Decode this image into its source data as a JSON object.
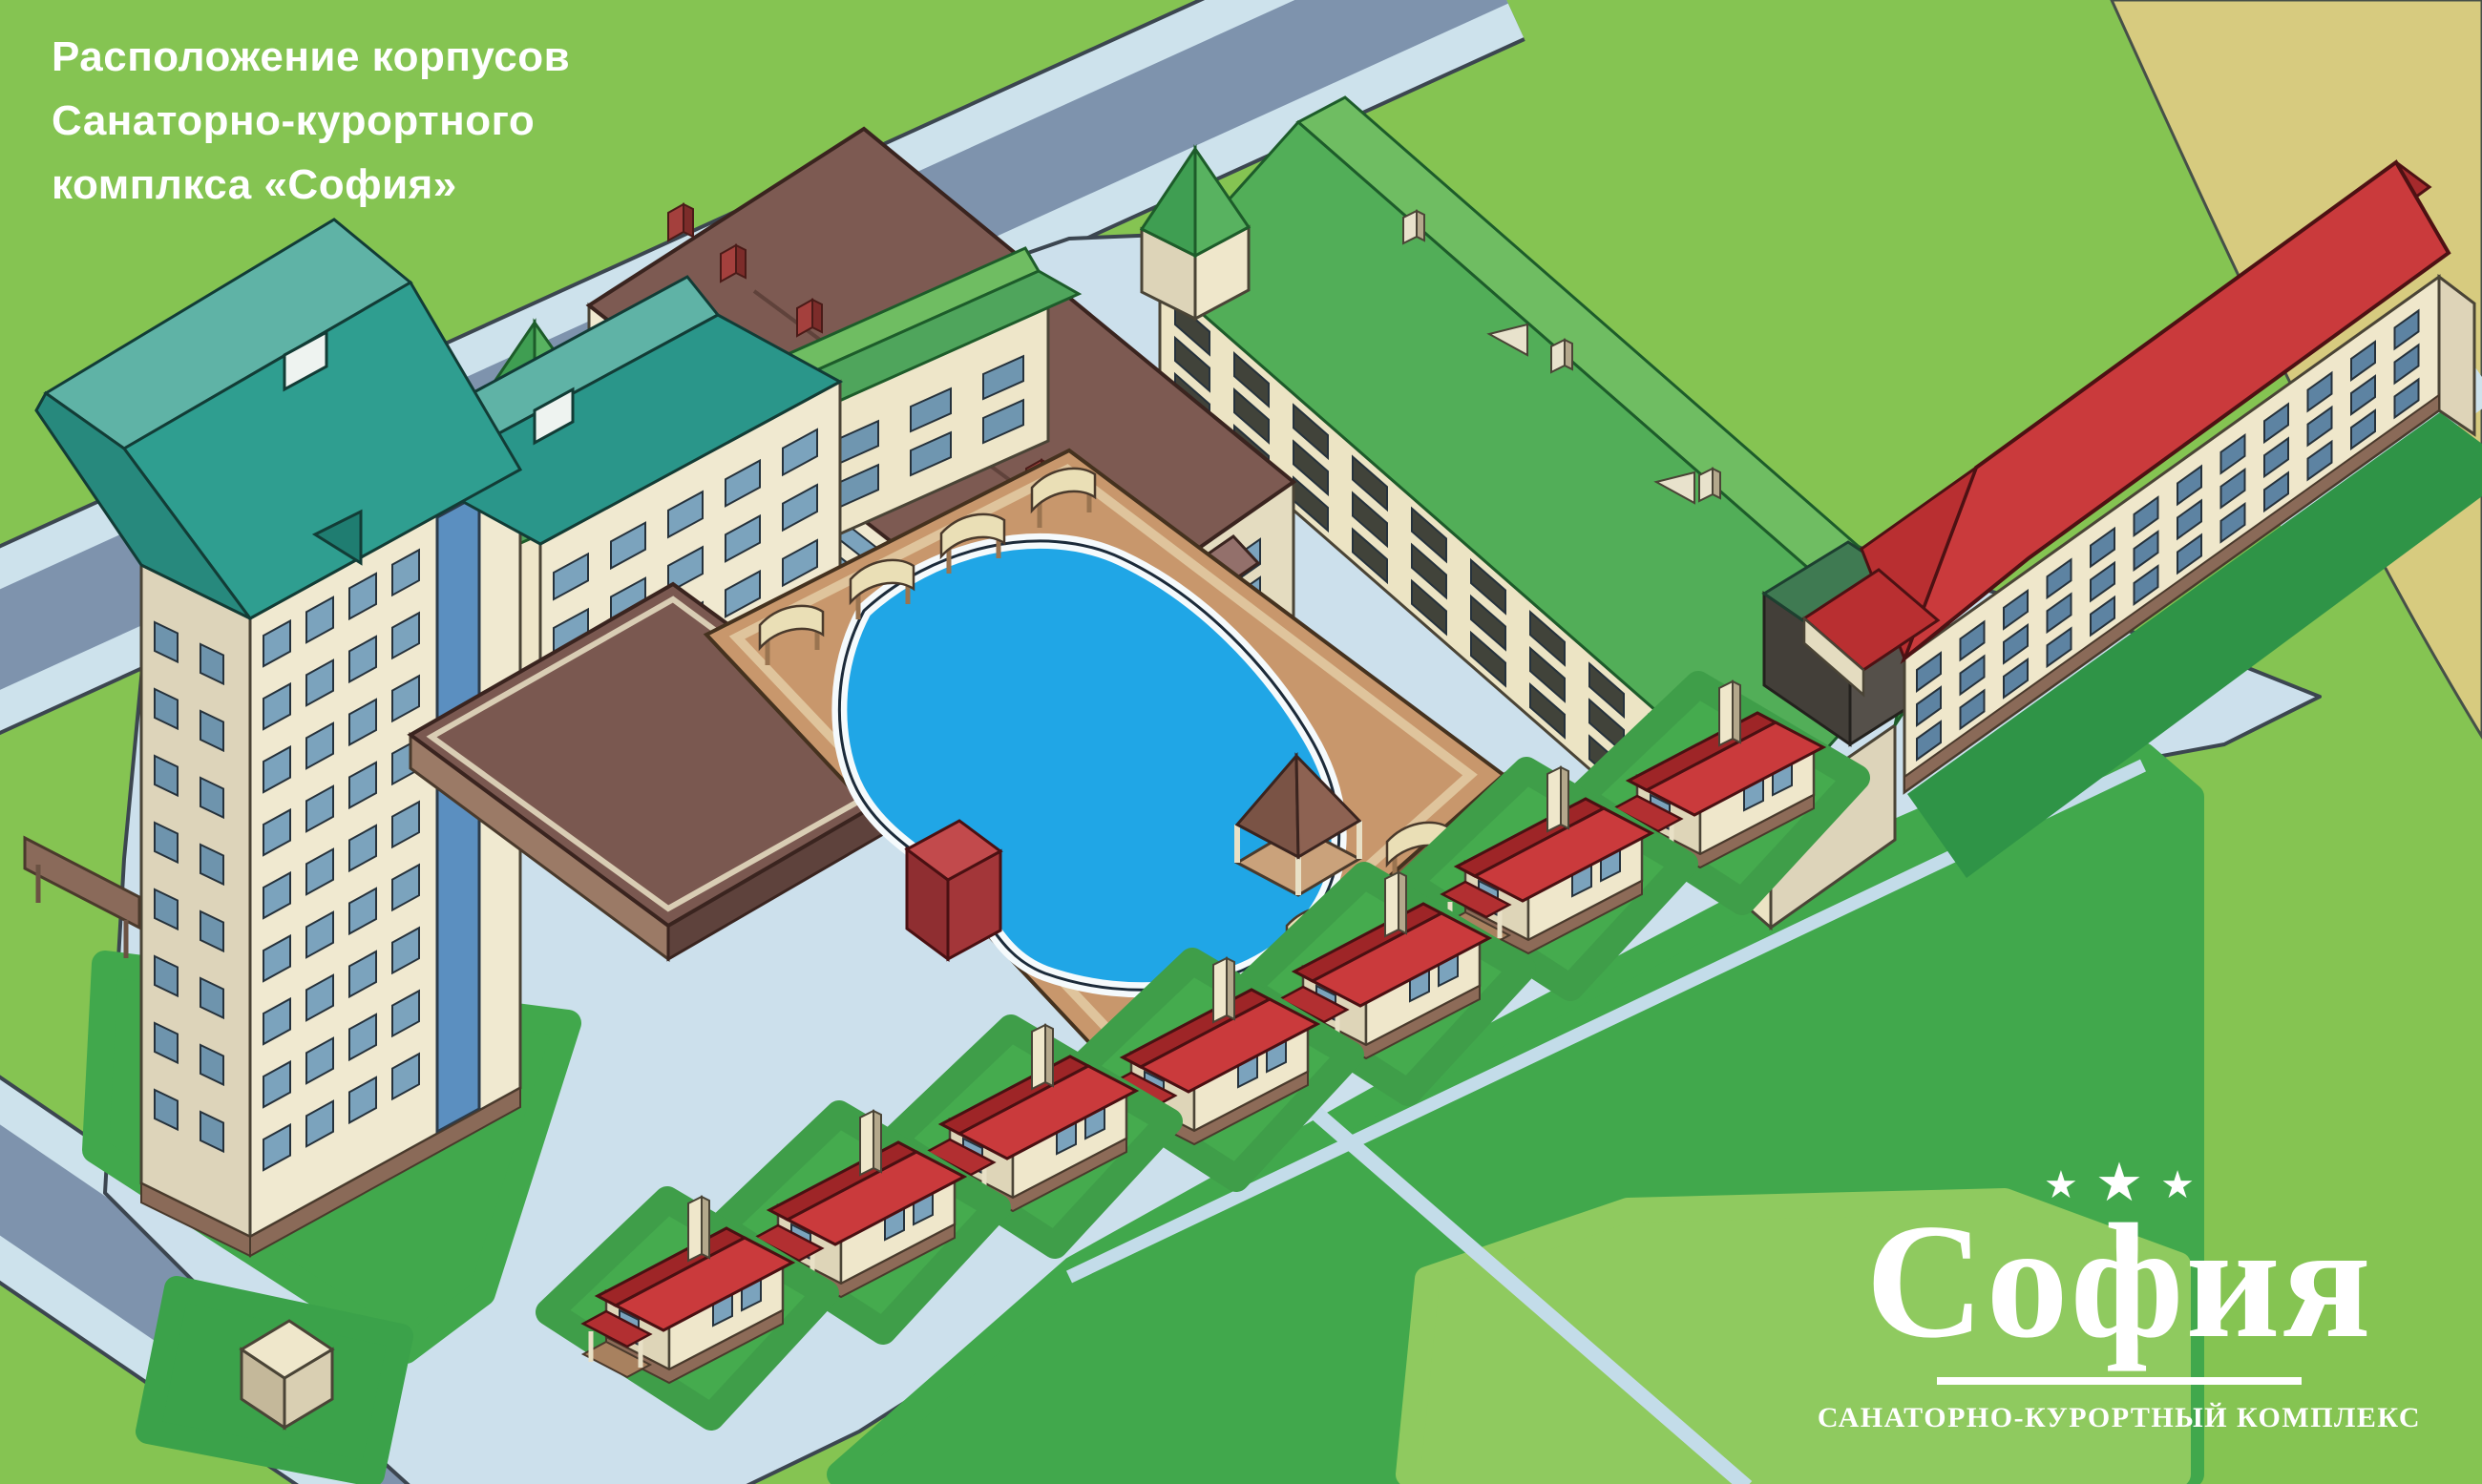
{
  "title": {
    "lines": [
      "Расположение корпусов",
      "Санаторно-курортного",
      "комплкса «София»"
    ]
  },
  "logo": {
    "stars": [
      "★",
      "★",
      "★"
    ],
    "name": "София",
    "subtitle": "САНАТОРНО-КУРОРТНЫЙ КОМПЛЕКС"
  },
  "scene": {
    "type": "isometric resort site plan illustration",
    "features": {
      "cottages_count": 7,
      "pool": "kidney-shaped outdoor swimming pool with deck, sun awnings, kiosk and gazebo",
      "buildings": [
        "teal-roof main hotel",
        "brown-roof central hotel with curved glass corner",
        "green-roof north wing",
        "green-roof northeast building",
        "red-roof east building",
        "red-roof guest cottages",
        "flat-roof annex",
        "utility shed"
      ]
    },
    "palette": {
      "grass": "#85c452",
      "field_khaki": "#d7cb7f",
      "road": "#7e93ad",
      "sidewalk": "#cde2ec",
      "plaza": "#cce0ec",
      "lawn": "#41a84c",
      "lawn_light": "#8fca5f",
      "teal_roof": "#2f9e90",
      "teal_roof_light": "#5fb3a6",
      "green_roof": "#52ae58",
      "green_roof_light": "#6fbd62",
      "brown_roof": "#7d5a52",
      "red_roof": "#ca3a3c",
      "wall_cream": "#f0e9d0",
      "wall_cream_shade": "#ddd4ba",
      "window_blue": "#7ba3bd",
      "pool_water": "#20a6e6",
      "pool_deck": "#c8976c",
      "shadow_green": "#2f9447"
    }
  }
}
